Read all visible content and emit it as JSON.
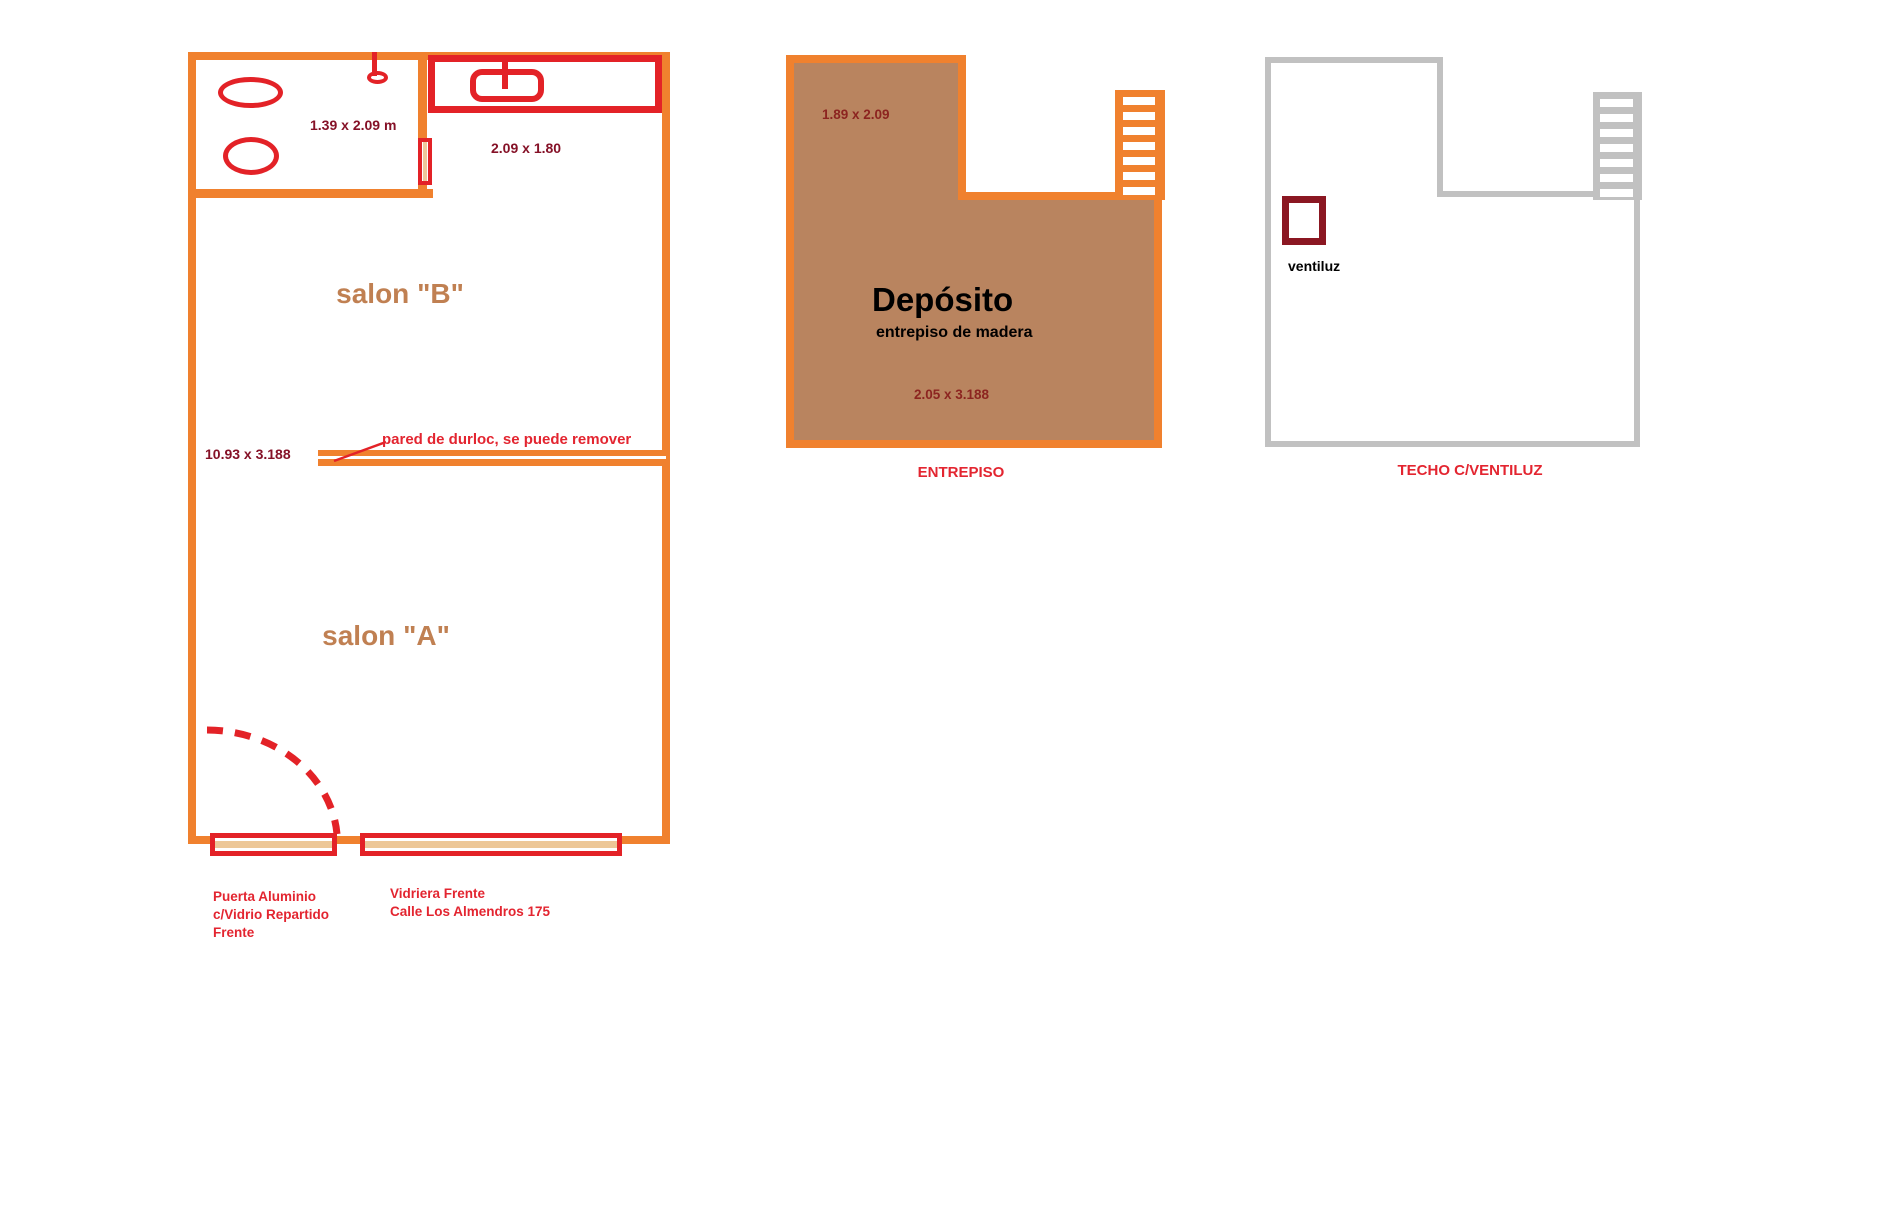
{
  "floor_plan": {
    "bathroom_dim": "1.39 x 2.09 m",
    "toilette_dim": "2.09 x 1.80",
    "salon_b_label": "salon \"B\"",
    "salon_a_label": "salon \"A\"",
    "partition_note": "pared de durloc, se puede remover",
    "salon_dim": "10.93 x 3.188",
    "door_caption": "Puerta Aluminio\nc/Vidrio Repartido\nFrente",
    "storefront_caption": "Vidriera Frente\nCalle Los Almendros 175"
  },
  "entrepiso": {
    "upper_dim": "1.89 x 2.09",
    "room_title": "Depósito",
    "room_subtitle": "entrepiso de madera",
    "lower_dim": "2.05 x 3.188",
    "caption": "ENTREPISO"
  },
  "techo": {
    "ventiluz_label": "ventiluz",
    "caption": "TECHO C/VENTILUZ"
  },
  "colors": {
    "wall_orange": "#f0812e",
    "fixture_red": "#e32227",
    "text_red": "#e32530",
    "dim_maroon": "#851127",
    "mezzanine_brown": "#b9845f",
    "salon_label_brown": "#c08052",
    "roof_outline_gray": "#c1c1c1",
    "ventiluz_maroon": "#8b1722",
    "glass_fill_tan": "#edc797",
    "text_black": "#000000"
  },
  "icons": {
    "toilet-icon": "ellipse outline",
    "bidet-icon": "ellipse outline",
    "shower-icon": "stem line with small ellipse head",
    "sink-icon": "rounded rectangle with faucet stem",
    "door-leaf-icon": "red rectangle with tan glass stripe",
    "door-swing-arc-icon": "dashed quarter-circle arc",
    "stairs-icon": "ladder with rungs",
    "ventiluz-icon": "small maroon square"
  }
}
